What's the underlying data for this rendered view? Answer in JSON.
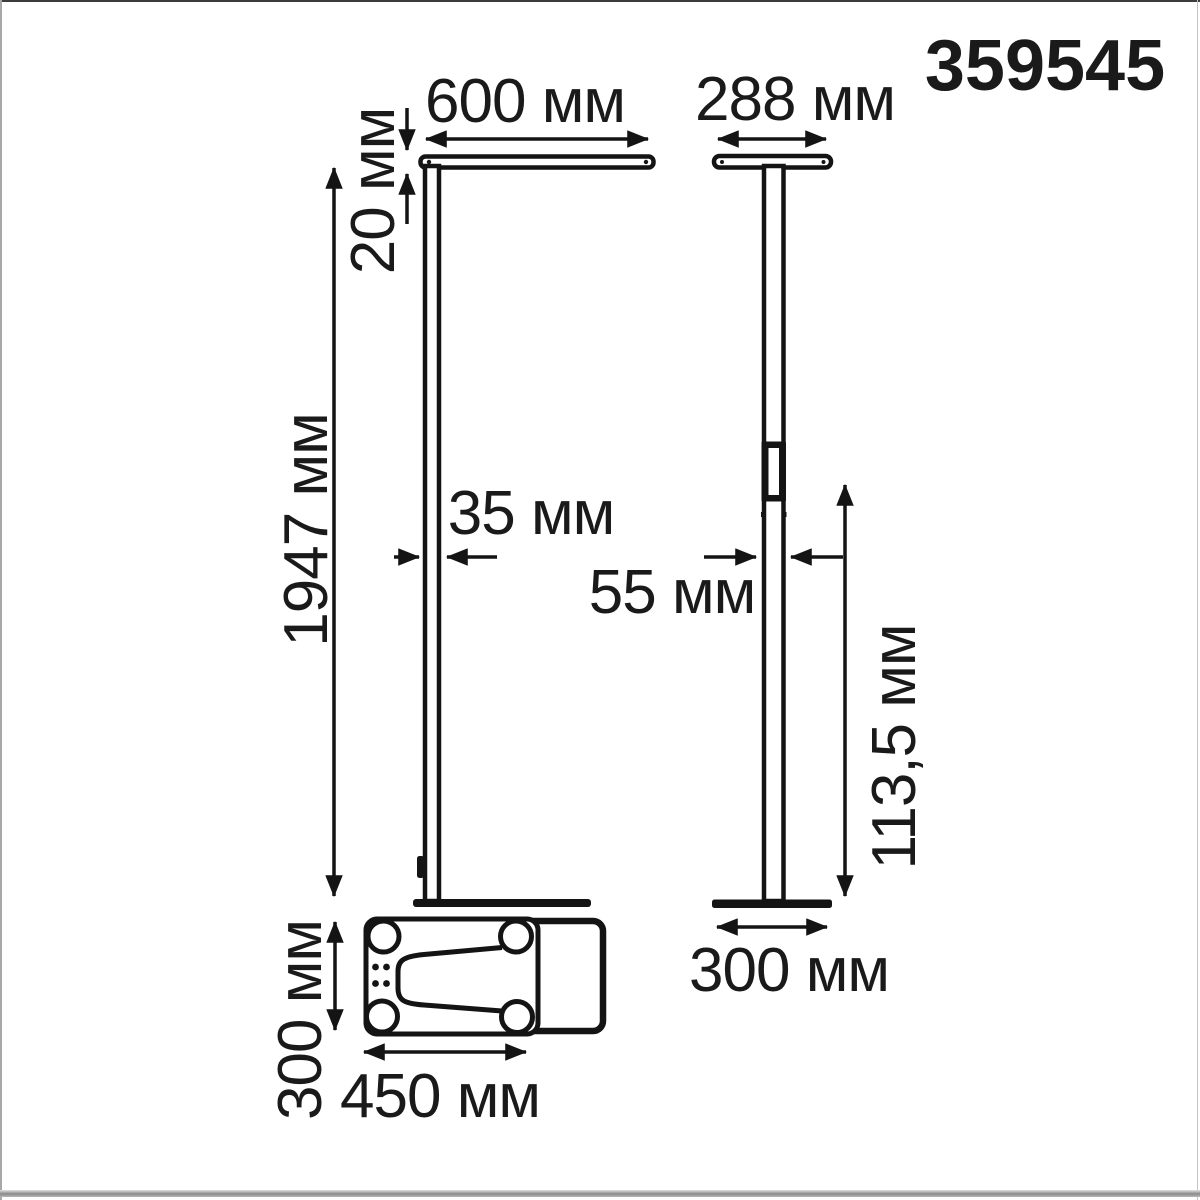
{
  "product_number": "359545",
  "units": "мм",
  "front_view": {
    "head_width_label": "600 мм",
    "head_thickness_label": "20 мм",
    "height_label": "1947 мм",
    "pole_width_label": "35 мм",
    "base_depth_label": "300 мм",
    "base_length_label": "450 мм"
  },
  "side_view": {
    "head_depth_label": "288 мм",
    "pole_depth_label": "55 мм",
    "switch_height_label": "113,5 мм",
    "base_width_label": "300 мм"
  },
  "colors": {
    "line": "#141414",
    "background": "#ffffff",
    "bottom_bar": "#8a8a8a"
  }
}
